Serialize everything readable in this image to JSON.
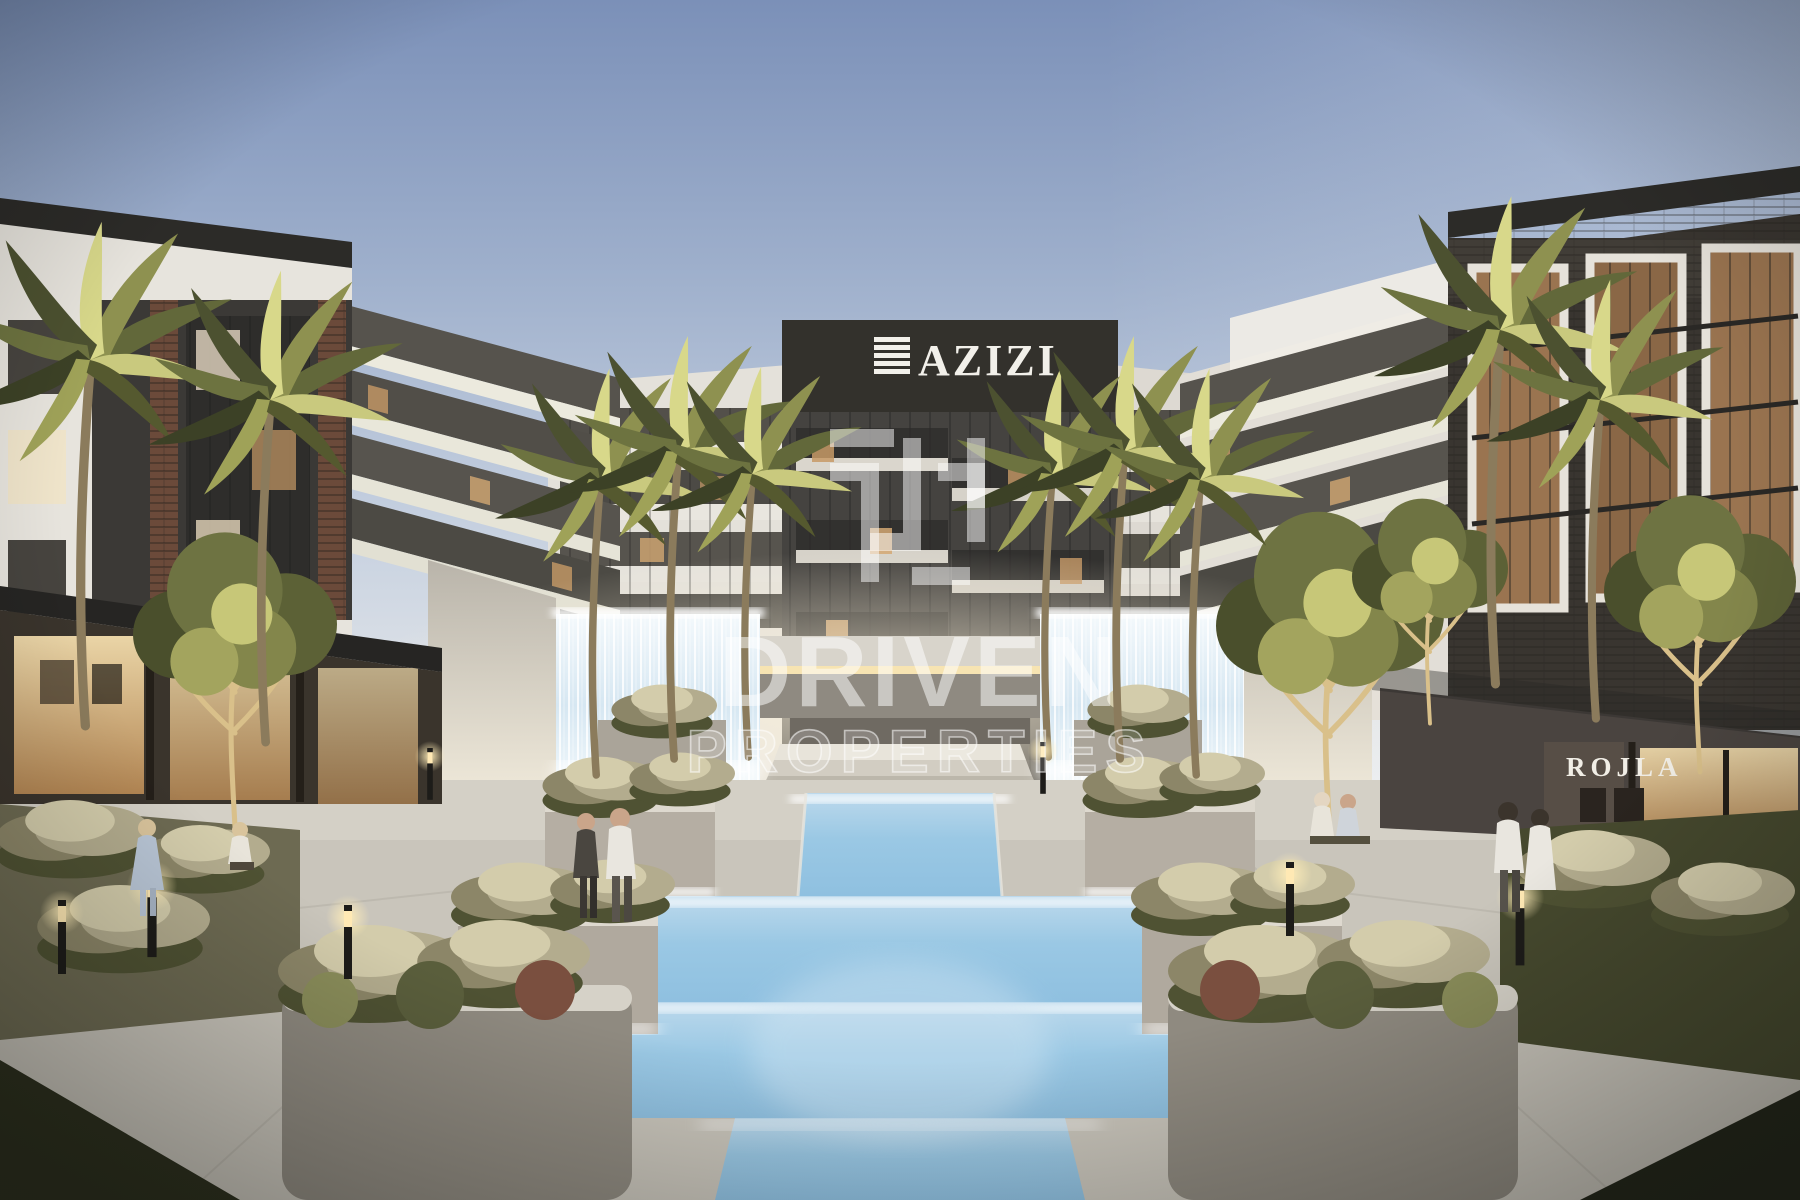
{
  "signs": {
    "azizi": {
      "label": "AZIZI",
      "logo_icon": "azizi-stripes-icon",
      "text_color": "#f2f0ea",
      "panel_color": "#33312c"
    },
    "rojla": {
      "label": "ROJLA",
      "text_color": "#f1eee6"
    }
  },
  "watermark": {
    "logo_icon": "driven-window-icon",
    "line1": "DRIVEN",
    "line2": "PROPERTIES",
    "color": "#ffffff"
  },
  "scene": {
    "colors": {
      "sky_top": "#7b90b8",
      "sky_mid": "#aebfd6",
      "sky_horizon": "#e9ebec",
      "facade_white": "#e8e5df",
      "facade_dark": "#3a3834",
      "brick": "#6b4a3a",
      "pool_water": "#9ac8e4",
      "pool_deep": "#7fb6da",
      "foliage_dark": "#4a4f2c",
      "foliage_mid": "#7a7d46",
      "foliage_lit": "#d6d784",
      "warm_light": "#e8c48c",
      "paving": "#c9c5bb",
      "concrete": "#b5aea3"
    }
  }
}
